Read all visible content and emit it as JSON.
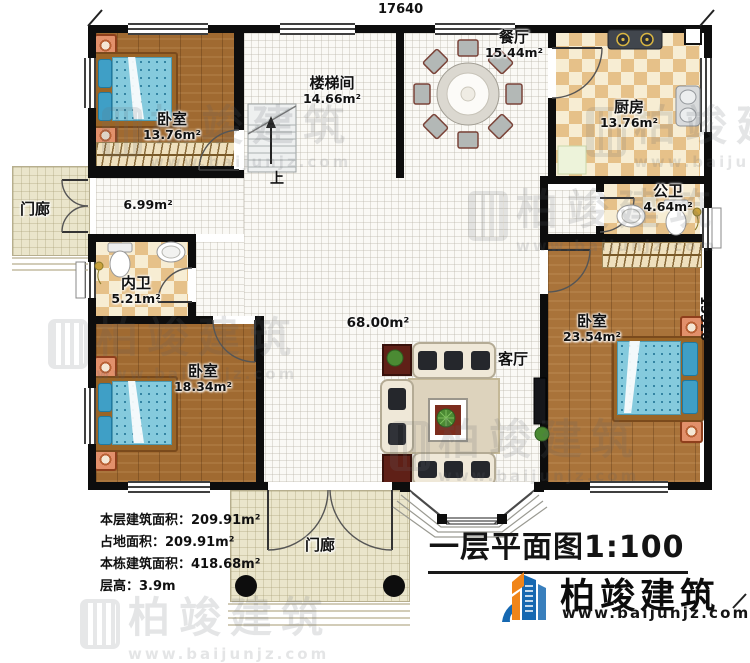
{
  "drawing": {
    "title": "一层平面图",
    "scale": "1:100",
    "up_label": "上",
    "dimensions": {
      "top": "17640",
      "right": "15320"
    }
  },
  "rooms": [
    {
      "id": "bedroom-top-left",
      "name": "卧室",
      "area": "13.76m²"
    },
    {
      "id": "stairwell",
      "name": "楼梯间",
      "area": "14.66m²"
    },
    {
      "id": "dining-room",
      "name": "餐厅",
      "area": "15.44m²"
    },
    {
      "id": "kitchen",
      "name": "厨房",
      "area": "13.76m²"
    },
    {
      "id": "public-bathroom",
      "name": "公卫",
      "area": "4.64m²"
    },
    {
      "id": "porch-left",
      "name": "门廊",
      "area": ""
    },
    {
      "id": "corridor",
      "name": "",
      "area": "6.99m²"
    },
    {
      "id": "private-bathroom",
      "name": "内卫",
      "area": "5.21m²"
    },
    {
      "id": "hall",
      "name": "",
      "area": "68.00m²"
    },
    {
      "id": "living-room",
      "name": "客厅",
      "area": ""
    },
    {
      "id": "bedroom-bottom-left",
      "name": "卧室",
      "area": "18.34m²"
    },
    {
      "id": "bedroom-right",
      "name": "卧室",
      "area": "23.54m²"
    },
    {
      "id": "porch-bottom",
      "name": "门廊",
      "area": ""
    }
  ],
  "stats": {
    "lines": [
      "本层建筑面积：209.91m²",
      "占地面积：209.91m²",
      "本栋建筑面积：418.68m²",
      "层高：3.9m"
    ]
  },
  "branding": {
    "company": "柏竣建筑",
    "website": "www.baijunjz.com"
  },
  "watermark": {
    "company": "柏竣建筑",
    "website": "www.baijunjz.com"
  },
  "colors": {
    "wall": "#0d0d0d",
    "wood_floor": "#a06a31",
    "tile": "#e6c189",
    "brand_blue": "#1668b1",
    "brand_orange": "#f08519",
    "bed_blue": "#85cadd"
  }
}
